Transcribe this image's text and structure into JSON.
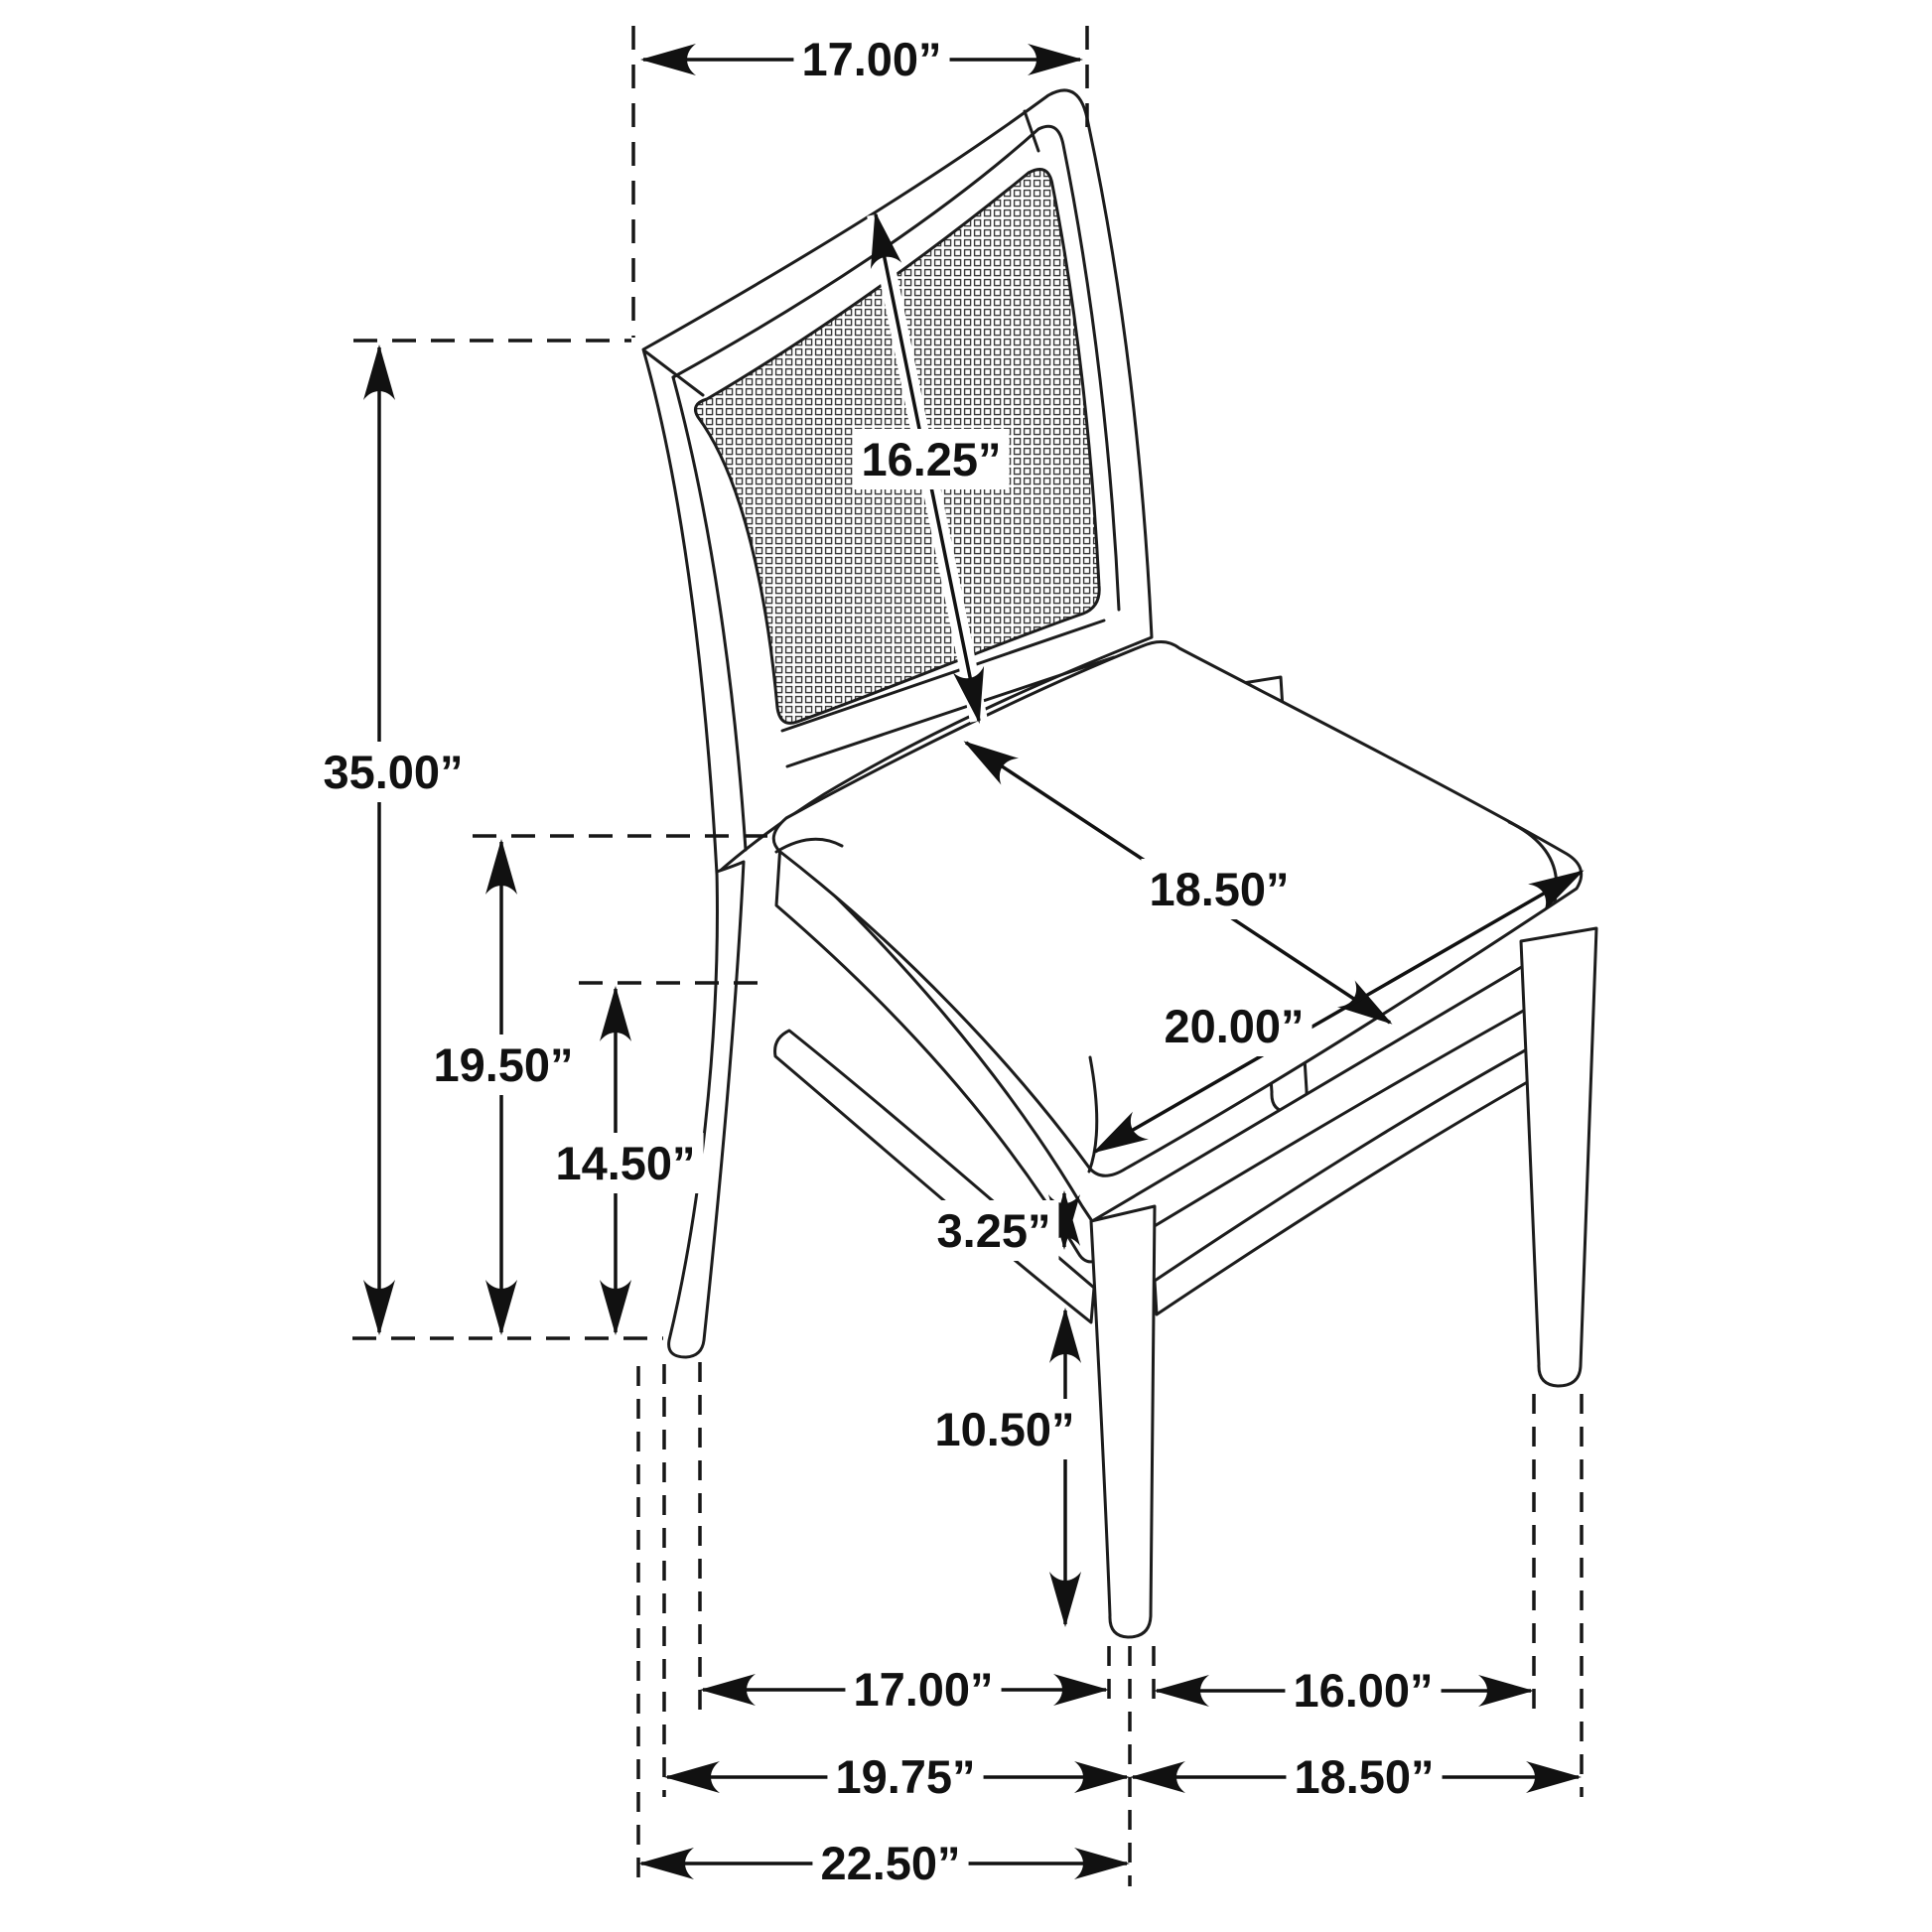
{
  "figure": {
    "type": "furniture-dimension-diagram",
    "subject": "dining side chair with cane webbing back and upholstered seat",
    "unit": "inches",
    "view": "three-quarter perspective line drawing"
  },
  "colors": {
    "background": "#ffffff",
    "line": "#1c1c1c",
    "dimension": "#111111"
  },
  "labels": {
    "top_back_width": "17.00”",
    "back_panel_diagonal": "16.25”",
    "overall_height": "35.00”",
    "seat_height": "19.50”",
    "apron_bottom_height": "14.50”",
    "seat_depth": "18.50”",
    "seat_width": "20.00”",
    "apron_thickness": "3.25”",
    "stretcher_clearance": "10.50”",
    "front_leg_spacing": "17.00”",
    "side_leg_spacing": "16.00”",
    "front_width_overall": "19.75”",
    "side_depth_overall": "18.50”",
    "overall_depth": "22.50”"
  }
}
